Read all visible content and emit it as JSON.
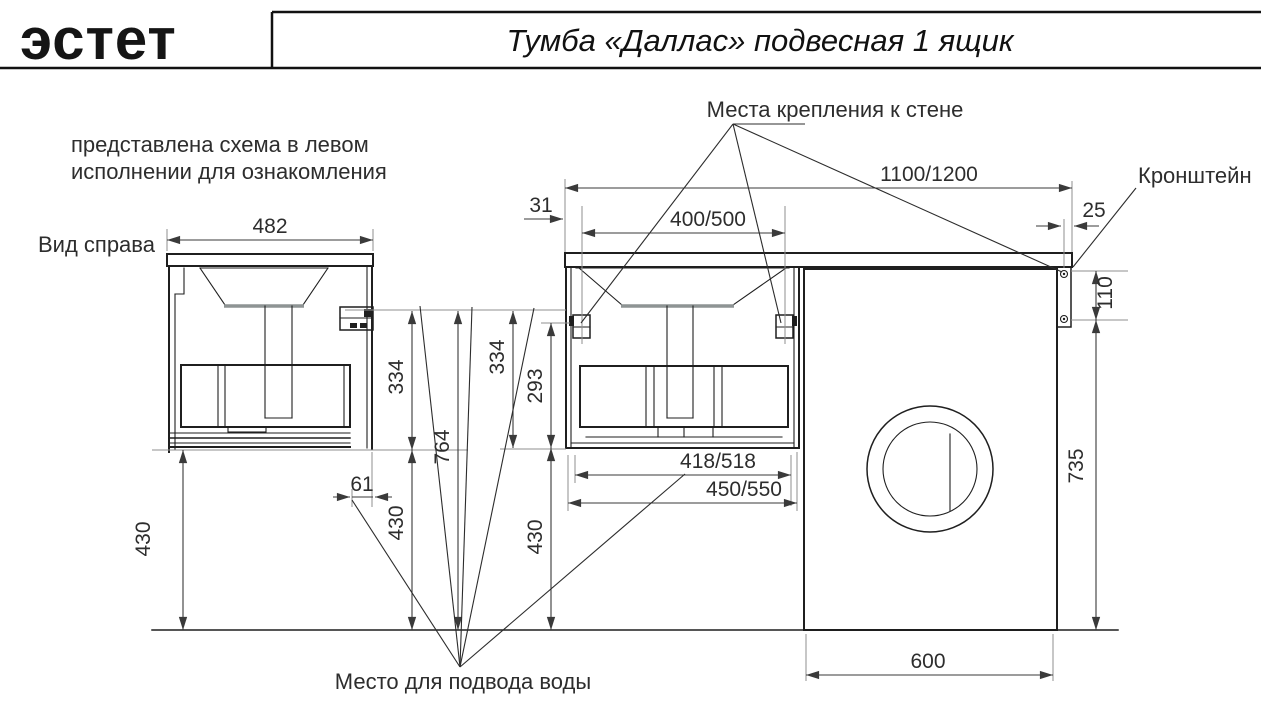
{
  "header": {
    "logo": "эстет",
    "title": "Тумба «Даллас» подвесная 1 ящик"
  },
  "note": {
    "line1": "представлена схема в левом",
    "line2": "исполнении для ознакомления",
    "color": "#c94a46"
  },
  "labels": {
    "view": "Вид справа",
    "wall_mount": "Места крепления к стене",
    "bracket": "Кронштейн",
    "water": "Место для подвода воды"
  },
  "dimensions": {
    "top_width": "482",
    "offset_31": "31",
    "mount_span": "400/500",
    "total_width": "1100/1200",
    "edge_25": "25",
    "bracket_110": "110",
    "side_334": "334",
    "height_764": "764",
    "floor_430_left": "430",
    "floor_430_mid": "430",
    "back_offset_61": "61",
    "front_334": "334",
    "inner_293": "293",
    "floor_430_center": "430",
    "drawer_418": "418/518",
    "cabinet_450": "450/550",
    "washer_735": "735",
    "washer_600": "600"
  },
  "colors": {
    "line": "#1f1f1f",
    "dimension": "#3a3a3a",
    "extension": "#8f8f8f",
    "note_red": "#c94a46"
  }
}
